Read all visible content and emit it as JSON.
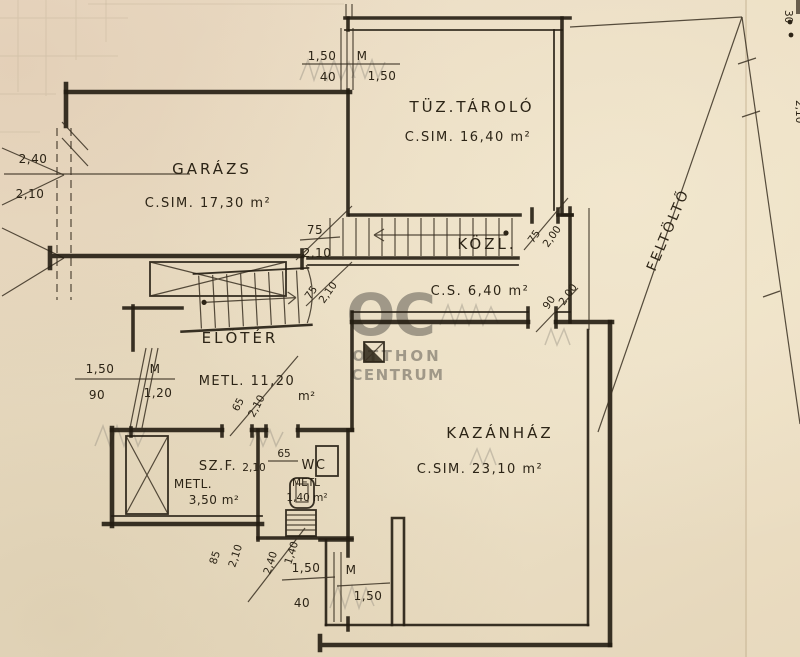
{
  "document": {
    "kind": "scanned hand-drawn basement floor plan",
    "language": "Hungarian"
  },
  "watermark": {
    "logo": "OC",
    "line1": "OTTHON",
    "line2": "CENTRUM"
  },
  "rooms": {
    "tuz_tarolo": {
      "name": "TÜZ.TÁROLÓ",
      "area": "C.SIM. 16,40 m²"
    },
    "garazs": {
      "name": "GARÁZS",
      "area": "C.SIM. 17,30 m²"
    },
    "kozl": {
      "name": "KÖZL.",
      "area": "C.S. 6,40 m²"
    },
    "eloter": {
      "name": "ELŐTÉR",
      "area": "METL. 11,20",
      "unit": "m²"
    },
    "szf": {
      "name": "SZ.F.",
      "mat": "METL.",
      "area": "3,50 m²"
    },
    "wc": {
      "name": "WC",
      "mat": "METL",
      "area": "1,40 m²"
    },
    "kazanhaz": {
      "name": "KAZÁNHÁZ",
      "area": "C.SIM. 23,10 m²"
    }
  },
  "ramp": {
    "label": "FELTÖLTŐ",
    "dim_top": "30",
    "dim_side": "2,10"
  },
  "dims": {
    "tuz_window": {
      "w": "1,50",
      "parapet": "40",
      "m": "M",
      "h": "1,50"
    },
    "garage_door": {
      "w": "2,40",
      "h": "2,10"
    },
    "stair_door_left": {
      "w": "75",
      "h": "2,10"
    },
    "stair_door_left2": {
      "w": "75",
      "h": "2,10"
    },
    "stair_door_right": {
      "w": "75",
      "h": "2,00"
    },
    "kazan_door": {
      "w": "90",
      "h": "2,00"
    },
    "eloter_window": {
      "w": "1,50",
      "parapet": "90",
      "m": "M",
      "h": "1,20"
    },
    "eloter_door": {
      "w": "65",
      "h": "2,10"
    },
    "wc_door": {
      "w": "65",
      "h": "2,10"
    },
    "szf_door": {
      "w": "85",
      "h": "2,10"
    },
    "bottom_door": {
      "w": "2,40",
      "h": "1,40"
    },
    "kazan_window": {
      "w": "1,50",
      "parapet": "40",
      "m": "M",
      "h": "1,50"
    }
  }
}
